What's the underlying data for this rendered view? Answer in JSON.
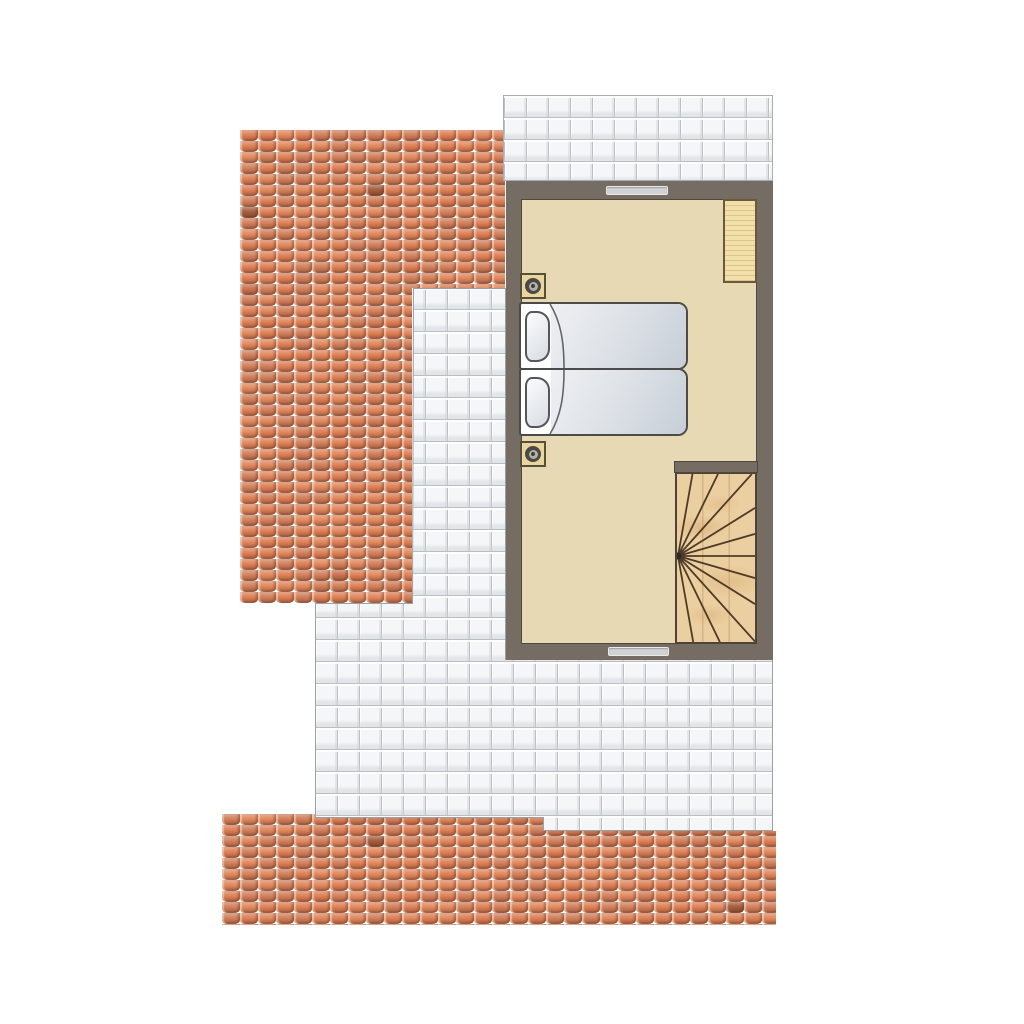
{
  "floor_plan": {
    "kind": "residential upper-floor plan, top-down view, no text labels",
    "bedroom": {
      "walls": "dark taupe band enclosing room, opening to winder staircase at lower right",
      "window_count": 2,
      "furniture": {
        "single_beds": 2,
        "pillows": 2,
        "nightstands_with_lamp": 2,
        "wardrobes": 1
      }
    },
    "staircase": {
      "type": "winder / quarter-turn fan staircase",
      "visible_step_lines": 11,
      "visible_treads": 12,
      "material": "light wood"
    },
    "roofs": {
      "left_pitched_roof": "L-shaped terracotta pan-tile roof, upper left",
      "bottom_pitched_roof": "horizontal terracotta pan-tile strip, bottom",
      "flat_roof_terrace": "white square tiles, wraps above room and around lower left of room",
      "upper_terrace_strip": "white square tiles above bedroom"
    },
    "colors": {
      "background": "#ffffff",
      "wall": "#756c64",
      "room_outline": "#4e483f",
      "floor": "#e6d9b4",
      "terrace_tile": "#f5f6f8",
      "terrace_grout": "#b9bdc4",
      "terrace_border": "#a9aeb4",
      "stair_wood": "#eccfa0",
      "stair_step_line": "#4e3c28",
      "wardrobe": "#f2dfa9",
      "wardrobe_outline": "#6b5a39",
      "nightstand": "#e9d69f",
      "nightstand_outline": "#56503b",
      "bed_frame": "#ffffff",
      "bed_outline": "#4b4b49",
      "duvet_light": "#eef0f3",
      "duvet_dark": "#c7ced7",
      "pillow_light": "#fbfcfd",
      "pillow_dark": "#d8dde3",
      "window": "#d1d2d4",
      "roof_palette": [
        "#DE8157",
        "#D07A55",
        "#E0936C",
        "#C06B46",
        "#E28A60",
        "#A25E3E",
        "#8F5136",
        "#E5A07A",
        "#D2815C",
        "#C97350",
        "#DD8A66",
        "#B96A48"
      ]
    }
  }
}
